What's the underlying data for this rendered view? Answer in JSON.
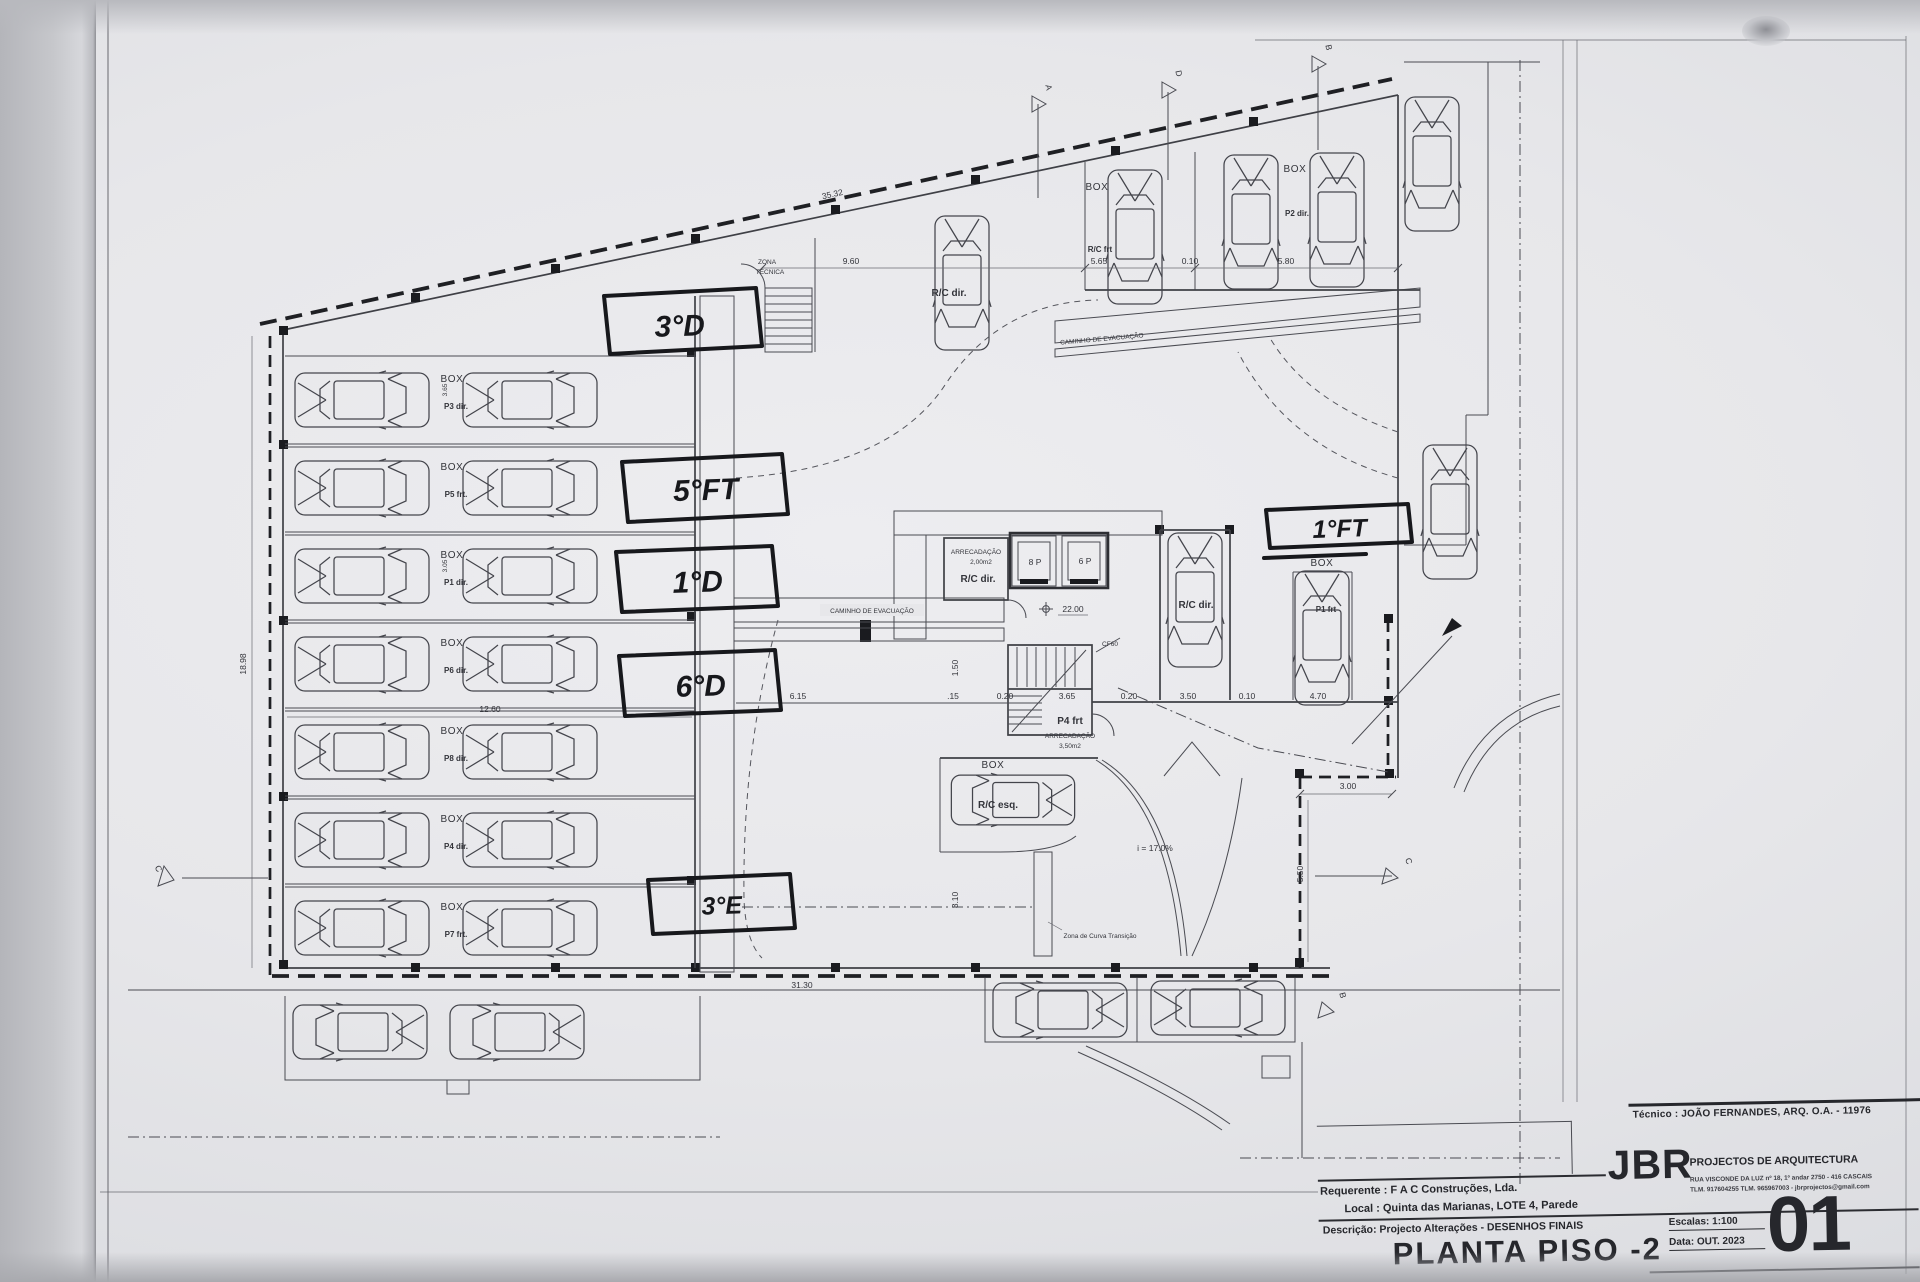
{
  "title_block": {
    "tecnico": "Técnico : JOÃO FERNANDES, ARQ.   O.A. - 11976",
    "requerente_label": "Requerente :",
    "requerente": "F A C  Construções, Lda.",
    "local_label": "Local :",
    "local": "Quinta das Marianas, LOTE 4, Parede",
    "descricao_label": "Descrição:",
    "descricao": "Projecto Alterações - DESENHOS FINAIS",
    "drawing_title": "PLANTA PISO -2",
    "firm_initials": "JBR",
    "firm_name": "PROJECTOS DE ARQUITECTURA",
    "firm_address": "RUA VISCONDE DA LUZ nº 18, 1º andar  2750 - 416  CASCAIS",
    "firm_contact": "TLM. 917604255  TLM. 965967003 - jbrprojectos@gmail.com",
    "escala_label": "Escalas:",
    "escala": "1:100",
    "data_label": "Data:",
    "data": "OUT. 2023",
    "sheet_number": "01"
  },
  "plan": {
    "handwritten": {
      "u1": "3°D",
      "u2": "5°FT",
      "u3": "1°D",
      "u4": "6°D",
      "u5": "3°E",
      "u6": "1°FT"
    },
    "zones": {
      "zona_tecnica_line1": "ZONA",
      "zona_tecnica_line2": "TÉCNICA",
      "evacuation_path": "CAMINHO DE EVACUAÇÃO",
      "curve_zone": "Zona de Curva Transição",
      "ramp_slope": "i = 17.0%"
    },
    "core": {
      "lift_left": "8 P",
      "lift_right": "6 P",
      "level": "22.00",
      "fire_door": "CF60",
      "storage_label": "ARRECADAÇÃO",
      "storage_area_small": "2,00m2",
      "storage_area_large": "3,50m2",
      "storage_unit": "P4 frt",
      "storage_room_unit": "R/C dir."
    },
    "stalls": {
      "box": "BOX",
      "rc_frt": "R/C frt",
      "p2_dir": "P2 dir.",
      "rc_dir": "R/C dir.",
      "rc_esq": "R/C esq.",
      "p1_frt": "P1 frt",
      "left_rows": [
        "P3 dir.",
        "P5 frt.",
        "P1 dir.",
        "P6 dir.",
        "P8 dir.",
        "P4 dir.",
        "P7 frt."
      ]
    },
    "dims": {
      "v3532": "35.32",
      "v960": "9.60",
      "v565": "5.65",
      "v010": "0.10",
      "v580": "5.80",
      "v1898": "18.98",
      "v1260": "12.60",
      "v3130": "31.30",
      "v615": "6.15",
      "v015": ".15",
      "v020": "0.20",
      "v365": "3.65",
      "v350": "3.50",
      "v310": "3.10",
      "v150": "1.50",
      "v470": "4.70",
      "v300": "3.00",
      "v550": "5.50",
      "v305": "3.05"
    },
    "sections": {
      "a": "A",
      "b": "B",
      "c": "C",
      "d": "D"
    }
  }
}
